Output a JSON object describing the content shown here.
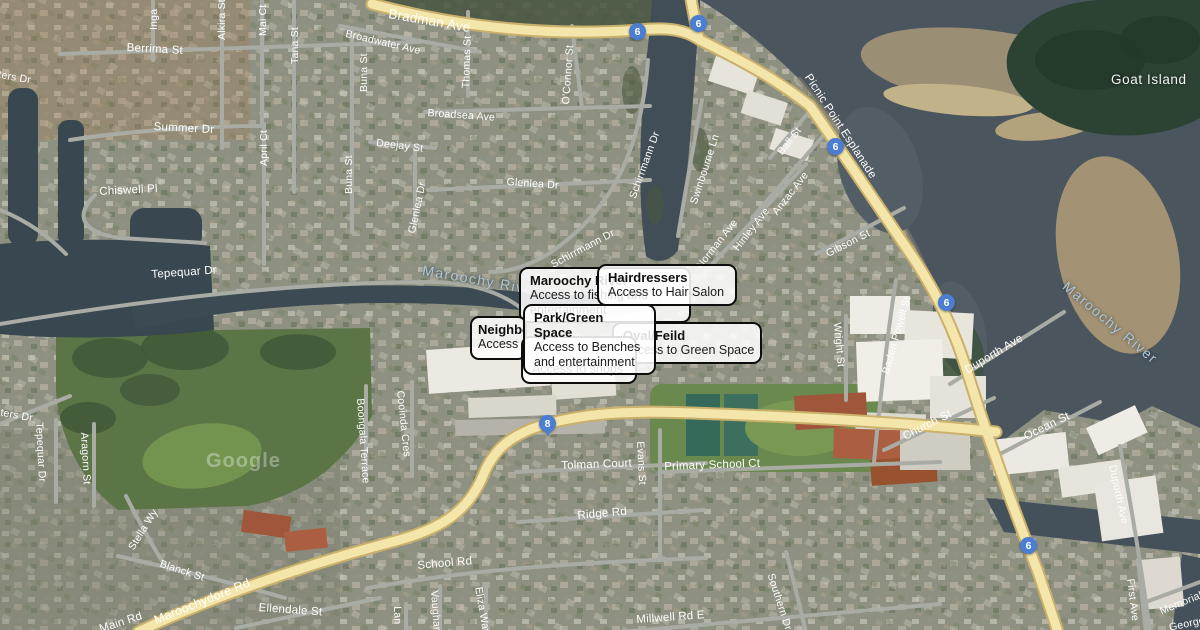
{
  "map": {
    "watermark": "Google",
    "labels": {
      "bradman": "Bradman Ave",
      "broadwater": "Broadwater Ave",
      "berrima": "Berrima St",
      "inga": "Inga",
      "alkira": "Alkira St",
      "mai": "Mai Ct",
      "tana": "Tana St",
      "buna": "Buna St",
      "thomas": "Thomas St",
      "oconnor": "O'Connor St",
      "april": "April Ct",
      "summer": "Summer Dr",
      "deejay": "Deejay St",
      "broadsea": "Broadsea Ave",
      "glenlea": "Glenlea Dr",
      "chiswell": "Chiswell Pl",
      "waters": "Waters Dr",
      "tepequar": "Tepequar Dr",
      "schirrmann": "Schirrmann Dr",
      "swinbourne": "Swinbourne Ln",
      "ball": "Ball St",
      "anzac": "Anzac Ave",
      "hinley": "Hinley Ave",
      "norman": "Norman Ave",
      "gibson": "Gibson St",
      "picnic": "Picnic Point Esplanade",
      "wright": "Wright St",
      "baden": "Baden Powell St",
      "church": "Church St",
      "ocean": "Ocean St",
      "duporth": "Duporth Ave",
      "first": "First Ave",
      "memorial": "Memorial Ave",
      "george": "George",
      "southern": "Southern Dr",
      "millwell": "Millwell Rd E",
      "school": "School Rd",
      "ridge": "Ridge Rd",
      "tolman": "Tolman Court",
      "primary": "Primary School Ct",
      "evans": "Evans St",
      "cooinda": "Cooinda Cres",
      "boongala": "Boongala Terrace",
      "aragorn": "Aragorn St",
      "stella": "Stella Wy",
      "blanck": "Blanck St",
      "ellendale": "Ellendale St",
      "vaughan": "Vaughan",
      "lan": "Lan",
      "eliza": "Eliza Way",
      "maroochydore": "Maroochydore Rd",
      "main": "Main Rd",
      "goat": "Goat Island",
      "river": "Maroochy River",
      "shopping_centre": "Shopping Centre"
    },
    "badges": {
      "six": "6",
      "eight": "8"
    },
    "colors": {
      "major_road": "#f4e6ab",
      "minor_road": "#a9aca4",
      "water": "#4a555e",
      "badge_blue": "#4b7ed2",
      "tooltip_border": "#0d0d0d"
    }
  },
  "tooltips": {
    "maroochy": {
      "title": "Maroochy River",
      "body": "Access to fishing and entertainment"
    },
    "hairdressers": {
      "title": "Hairdressers",
      "body": "Access to Hair Salon"
    },
    "neighbours": {
      "title": "Neighbo",
      "body": "Access"
    },
    "park": {
      "title": "Park/Green Space",
      "body": "Access to Benches and entertainment"
    },
    "oval": {
      "title": "Oval/Feild",
      "body": "Access to Green Space"
    },
    "shops": {
      "body": "Access to shops"
    }
  }
}
